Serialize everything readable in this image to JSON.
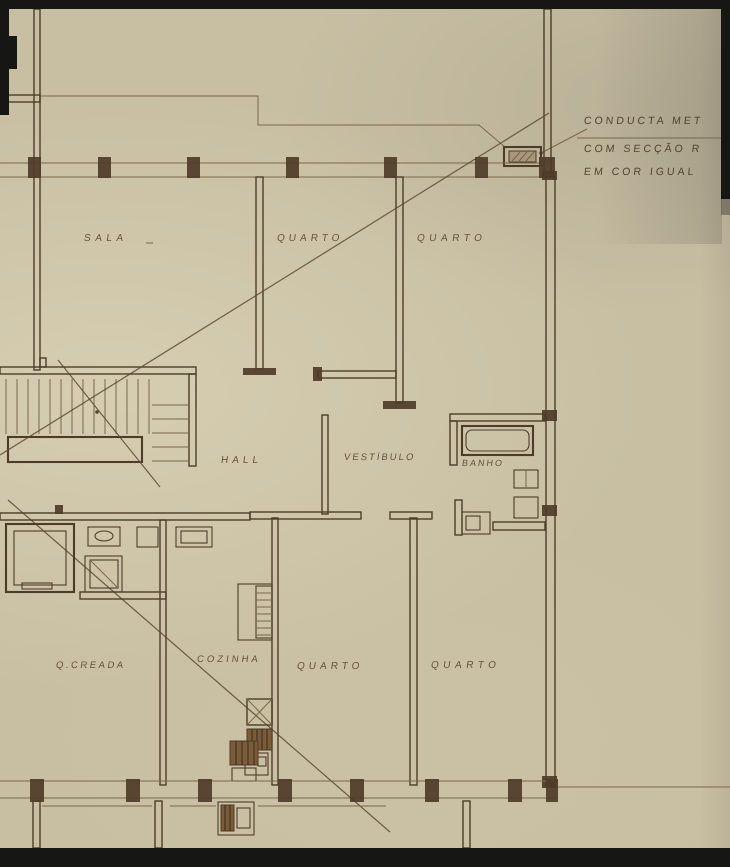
{
  "rooms": [
    {
      "id": "sala",
      "label": "SALA"
    },
    {
      "id": "quarto-1",
      "label": "QUARTO"
    },
    {
      "id": "quarto-2",
      "label": "QUARTO"
    },
    {
      "id": "hall",
      "label": "HALL"
    },
    {
      "id": "vestibulo",
      "label": "VESTÍBULO"
    },
    {
      "id": "banho",
      "label": "BANHO"
    },
    {
      "id": "q-creada",
      "label": "Q.CREADA"
    },
    {
      "id": "cozinha",
      "label": "COZINHA"
    },
    {
      "id": "quarto-3",
      "label": "QUARTO"
    },
    {
      "id": "quarto-4",
      "label": "QUARTO"
    }
  ],
  "annotation": {
    "line1": "CONDUCTA MET",
    "line2": "COM SECÇÃO R",
    "line3": "EM COR IGUAL"
  },
  "colors": {
    "paper": "#c8bfa3",
    "wall": "#4e3c28",
    "thin": "#7a6749",
    "diag": "#5a4731",
    "brown": "#7b5b3a",
    "label": "#5b4a35",
    "edge": "#161614"
  }
}
